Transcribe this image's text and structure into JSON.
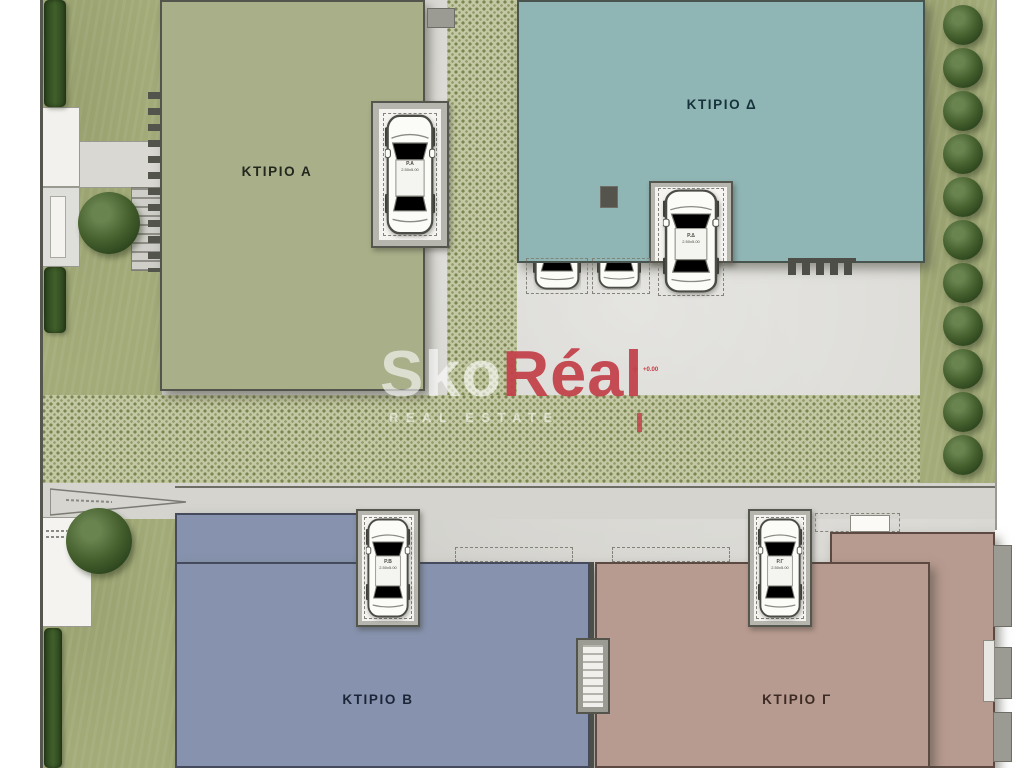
{
  "site": {
    "buildings": [
      {
        "key": "A",
        "label": "ΚΤΙΡΙΟ Α",
        "color": "#a9b089"
      },
      {
        "key": "D",
        "label": "ΚΤΙΡΙΟ Δ",
        "color": "#8fb5b5"
      },
      {
        "key": "B",
        "label": "ΚΤΙΡΙΟ Β",
        "color": "#8793ae"
      },
      {
        "key": "G",
        "label": "ΚΤΙΡΙΟ Γ",
        "color": "#b89b90"
      }
    ],
    "parking_spots": [
      {
        "id": "spot-a",
        "label": "Ρ.Α",
        "dims": "2.50x5.00"
      },
      {
        "id": "spot-d",
        "label": "Ρ.Δ",
        "dims": "2.50x5.00"
      },
      {
        "id": "spot-b",
        "label": "Ρ.Β",
        "dims": "2.50x5.00"
      },
      {
        "id": "spot-g",
        "label": "Ρ.Γ",
        "dims": "2.50x5.00"
      }
    ],
    "elevation_marker": "+0.00",
    "surfaces": {
      "pavement": "#d9d8d3",
      "grass_paver": "#c3c7a3",
      "grass": "#a3ab79",
      "tree": "#2c441d"
    }
  },
  "watermark": {
    "brand_primary": "Sko",
    "brand_secondary": "Réal",
    "subtitle": "REAL ESTATE",
    "accent": "#c2424b"
  }
}
